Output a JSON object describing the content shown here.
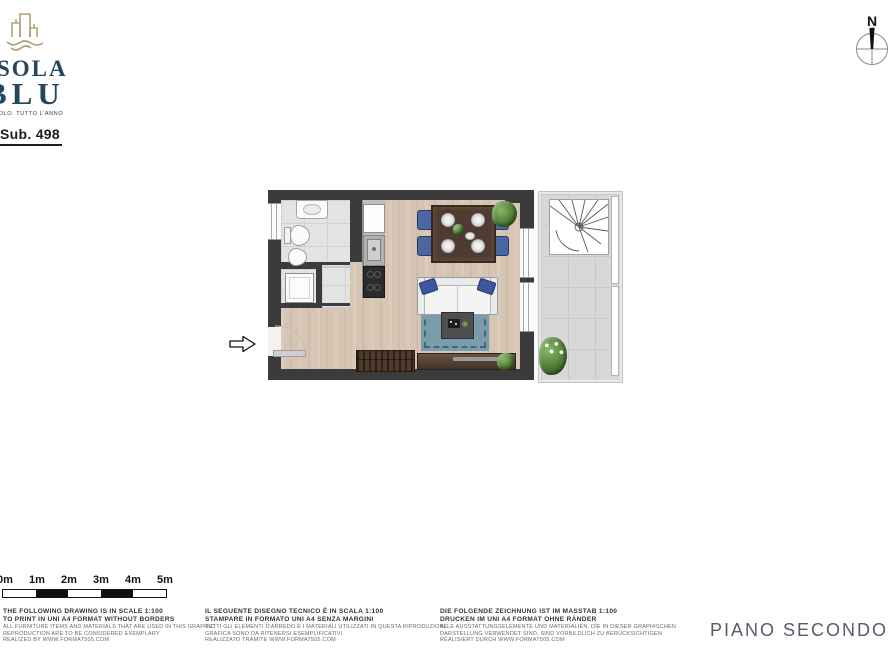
{
  "branding": {
    "name_line1": "ISOLA",
    "name_line2": "BLU",
    "tagline": "JESOLO. TUTTO L'ANNO",
    "unit_label": "Sub. 498",
    "brand_navy": "#24465f",
    "brand_gold": "#b3a077"
  },
  "compass": {
    "north_label": "N"
  },
  "plan": {
    "colors": {
      "wall": "#3b3b3b",
      "wood_floor": "#d7c5b3",
      "bath_tile": "#e3e3e3",
      "terrace_tile": "#d8d8d8",
      "rug_blue": "#7b9dab",
      "accent_blue": "#3a57a0",
      "furniture_brown": "#4f3c30",
      "plant_green": "#4e7d36"
    }
  },
  "scale_bar": {
    "labels": [
      "0m",
      "1m",
      "2m",
      "3m",
      "4m",
      "5m"
    ]
  },
  "disclaimers": {
    "en": {
      "lines": [
        "THE FOLLOWING DRAWING IS IN SCALE 1:100",
        "TO PRINT IN UNI A4 FORMAT WITHOUT BORDERS",
        "ALL FURNITURE ITEMS AND MATERIALS THAT ARE USED IN THIS GRAPHIC",
        "REPRODUCTION ARE TO BE CONSIDERED EXEMPLARY",
        "REALIZED BY WWW.FORMAT505.COM"
      ]
    },
    "it": {
      "lines": [
        "IL SEGUENTE DISEGNO TECNICO È IN SCALA 1:100",
        "STAMPARE IN FORMATO UNI A4 SENZA MARGINI",
        "TUTTI GLI ELEMENTI D'ARREDO E I MATERIALI UTILIZZATI IN QUESTA RIPRODUZIONE",
        "GRAFICA SONO DA RITENERSI ESEMPLIFICATIVI",
        "REALIZZATO TRAMITE WWW.FORMAT505.COM"
      ]
    },
    "de": {
      "lines": [
        "DIE FOLGENDE ZEICHNUNG IST IM MASSTAB 1:100",
        "DRUCKEN IM UNI A4 FORMAT OHNE RÄNDER",
        "ALLE AUSSTATTUNGSELEMENTE UND MATERIALIEN, DIE IN DIESER GRAPHISCHEN",
        "DARSTELLUNG VERWENDET SIND, SIND VORBILDLICH ZU BERÜCKSICHTIGEN",
        "REALISIERT DURCH WWW.FORMAT505.COM"
      ]
    }
  },
  "floor_label": "PIANO SECONDO"
}
